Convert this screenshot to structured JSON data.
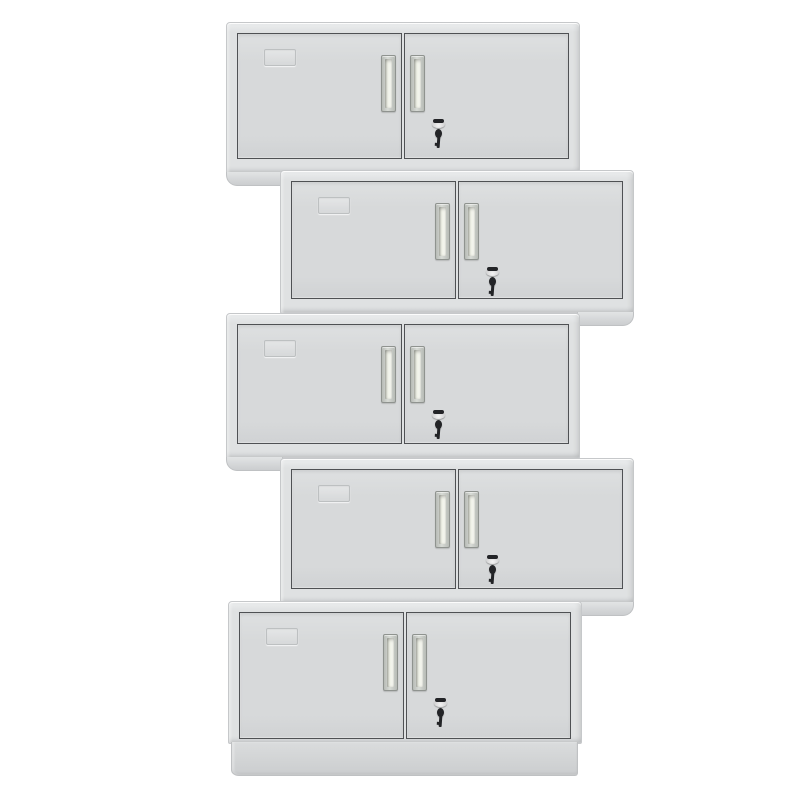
{
  "scene": {
    "subject": "five gray steel two-door office wall cabinets stacked in an alternating zig-zag tower",
    "background": "#ffffff",
    "cabinet_count": 5
  },
  "colors": {
    "bg": "#ffffff",
    "body-face": "#dfe1e2",
    "body-hi": "#eceeef",
    "body-lo": "#cfd1d3",
    "body-edge": "#c6c8ca",
    "door-face": "#d7d9da",
    "door-hi": "#dee0e1",
    "door-lo": "#d0d2d4",
    "line": "#4f5154",
    "foot-hi": "#e2e4e5",
    "foot-lo": "#cbcdcf",
    "foot-edge": "#bfc1c3",
    "handle-frame-a": "#b7bbb6",
    "handle-frame-b": "#d8dbd6",
    "handle-edge": "#8f938f",
    "recess-face": "#eef0e6",
    "recess-hi": "#fbfcf6",
    "recess-lo": "#c9ccc2",
    "metal-hi": "#f4f4f4",
    "metal-lo": "#c7c7c8",
    "key-dark": "#232427",
    "plate-edge": "#b9bcbd"
  },
  "cabinet_defaults": {
    "width": 352,
    "door_inset": {
      "top": 10,
      "side": 10,
      "bottom": 14
    },
    "parts_per_cabinet": {
      "doors": 2,
      "handles": 2,
      "label_plate_on": "left-door",
      "lock_with_key_on": "right-door"
    }
  },
  "cabinets": [
    {
      "id": "cabinet-1",
      "left": 226,
      "top": 22,
      "height": 150,
      "foot": "left"
    },
    {
      "id": "cabinet-2",
      "left": 280,
      "top": 170,
      "height": 142,
      "foot": "right"
    },
    {
      "id": "cabinet-3",
      "left": 226,
      "top": 313,
      "height": 144,
      "foot": "left"
    },
    {
      "id": "cabinet-4",
      "left": 280,
      "top": 458,
      "height": 144,
      "foot": "right"
    },
    {
      "id": "cabinet-5",
      "left": 228,
      "top": 601,
      "height": 141,
      "foot": "base",
      "base_height": 33,
      "door_bottom_inset": 4
    }
  ]
}
